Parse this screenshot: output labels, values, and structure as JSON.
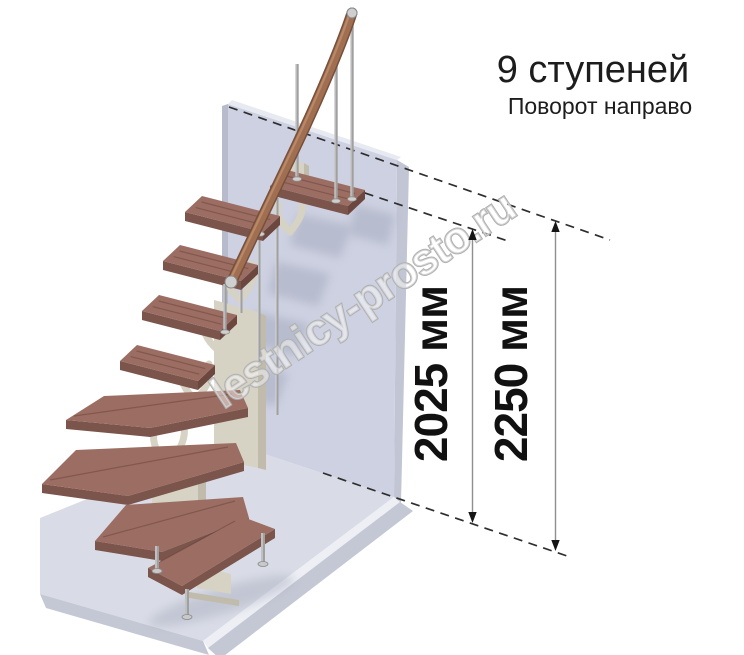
{
  "title": {
    "heading": "9 ступеней",
    "subheading": "Поворот направо"
  },
  "watermark": {
    "text": "lestnicy-prosto.ru"
  },
  "dimensions": {
    "items": [
      {
        "label": "2025 мм",
        "x": 472.5,
        "y_top": 229,
        "y_bottom": 523,
        "label_x": 447,
        "label_y": 374
      },
      {
        "label": "2250 мм",
        "x": 555.5,
        "y_top": 221,
        "y_bottom": 551,
        "label_x": 527,
        "label_y": 374
      }
    ],
    "dashed_levels": [
      {
        "name": "upper-floor-level",
        "x1": 229,
        "y1": 107,
        "x2": 610,
        "y2": 240
      },
      {
        "name": "top-step-level",
        "x1": 350,
        "y1": 188,
        "x2": 508,
        "y2": 241
      },
      {
        "name": "ground-level",
        "x1": 323,
        "y1": 473,
        "x2": 570,
        "y2": 557
      }
    ]
  },
  "colors": {
    "wall_front": "#cdd1e1",
    "wall_side": "#c1c5d4",
    "wall_top": "#e8eaf2",
    "wall_edge": "#b7bbcb",
    "floor_top": "#d9dce6",
    "floor_light": "#edeff5",
    "floor_dark": "#c4c7d4",
    "tread_top": "#9c6e63",
    "tread_front": "#7b544b",
    "tread_side": "#6b473f",
    "grain": "rgba(70,35,28,0.30)",
    "rail": "#a06f52",
    "rail_dark": "#77503c",
    "metal": "#a0a0a0",
    "metal_light": "#d6d6d6",
    "spine": "#d6d2c4",
    "spine_dark": "#c0bbaa",
    "dash": "#2e2e2e",
    "dim_line": "#8f8f8f",
    "arrow": "#151515",
    "shadow_wall": "#8b92a8",
    "shadow_floor": "#a8adbf"
  },
  "figure": {
    "wall": {
      "front": [
        [
          228,
          104
        ],
        [
          397,
          160
        ],
        [
          394,
          497
        ],
        [
          228,
          442
        ]
      ],
      "side": [
        [
          397,
          160
        ],
        [
          409,
          167
        ],
        [
          401,
          503
        ],
        [
          394,
          497
        ]
      ],
      "top": [
        [
          228,
          104
        ],
        [
          397,
          160
        ],
        [
          401,
          157
        ],
        [
          232,
          100
        ]
      ],
      "left": [
        [
          222,
          106
        ],
        [
          228,
          104
        ],
        [
          228,
          442
        ],
        [
          222,
          444
        ]
      ]
    },
    "floor": {
      "top": [
        [
          228,
          442
        ],
        [
          394,
          497
        ],
        [
          203,
          641
        ],
        [
          40,
          594
        ],
        [
          40,
          518
        ]
      ],
      "band_light": [
        [
          394,
          497
        ],
        [
          400,
          502
        ],
        [
          208,
          648
        ],
        [
          203,
          641
        ]
      ],
      "band_dark": [
        [
          400,
          502
        ],
        [
          413,
          511
        ],
        [
          220,
          659
        ],
        [
          208,
          648
        ]
      ],
      "band_left": [
        [
          203,
          641
        ],
        [
          209,
          655
        ],
        [
          46,
          608
        ],
        [
          40,
          594
        ]
      ]
    },
    "wall_shadows": [
      [
        [
          355,
          205
        ],
        [
          395,
          215
        ],
        [
          388,
          245
        ],
        [
          350,
          235
        ]
      ],
      [
        [
          298,
          214
        ],
        [
          352,
          226
        ],
        [
          340,
          258
        ],
        [
          290,
          245
        ]
      ],
      [
        [
          276,
          262
        ],
        [
          330,
          274
        ],
        [
          318,
          306
        ],
        [
          268,
          293
        ]
      ],
      [
        [
          255,
          312
        ],
        [
          309,
          324
        ],
        [
          297,
          356
        ],
        [
          247,
          343
        ]
      ],
      [
        [
          234,
          362
        ],
        [
          288,
          374
        ],
        [
          276,
          406
        ],
        [
          226,
          393
        ]
      ]
    ],
    "floor_shadow": {
      "cx": 222,
      "cy": 601,
      "rx": 76,
      "ry": 13,
      "rot": -17
    },
    "spine": {
      "columns": [
        {
          "face": [
            [
              214,
              300
            ],
            [
              258,
              312
            ],
            [
              258,
              468
            ],
            [
              214,
              458
            ]
          ],
          "side": [
            [
              258,
              312
            ],
            [
              266,
              316
            ],
            [
              266,
              470
            ],
            [
              258,
              468
            ]
          ]
        },
        {
          "face": [
            [
              152,
              468
            ],
            [
              198,
              478
            ],
            [
              198,
              548
            ],
            [
              152,
              540
            ]
          ],
          "side": [
            [
              198,
              478
            ],
            [
              206,
              482
            ],
            [
              206,
              550
            ],
            [
              198,
              548
            ]
          ]
        },
        {
          "face": [
            [
              286,
              158
            ],
            [
              304,
              163
            ],
            [
              304,
              182
            ],
            [
              286,
              177
            ]
          ],
          "side": [
            [
              304,
              163
            ],
            [
              309,
              166
            ],
            [
              309,
              184
            ],
            [
              304,
              182
            ]
          ]
        }
      ],
      "feet": [
        [
          [
            140,
            538
          ],
          [
            216,
            552
          ],
          [
            216,
            560
          ],
          [
            140,
            546
          ]
        ],
        [
          [
            189,
            592
          ],
          [
            239,
            600
          ],
          [
            239,
            606
          ],
          [
            189,
            598
          ]
        ]
      ],
      "bench_support": [
        [
          197,
          566
        ],
        [
          231,
          574
        ],
        [
          231,
          594
        ],
        [
          197,
          588
        ]
      ],
      "branches": [
        "M290,232 C300,220 304,212 302,200",
        "M290,232 C280,222 276,214 278,204",
        "M240,300 C252,286 256,276 252,264",
        "M240,300 C228,288 224,280 226,268",
        "M218,350 C230,336 234,326 231,314",
        "M218,350 C206,340 202,330 204,318",
        "M196,400 C208,386 212,376 209,364",
        "M196,400 C184,390 180,380 182,368",
        "M168,464 C182,448 186,438 184,424",
        "M168,464 C156,452 152,444 154,430",
        "M214,560 C224,548 228,540 226,530"
      ]
    },
    "treads": {
      "u": [
        78,
        20
      ],
      "v": [
        17,
        -16
      ],
      "thickness": 9,
      "straight": [
        {
          "name": "step-9",
          "fl": [
            270,
            186
          ]
        },
        {
          "name": "step-8",
          "fl": [
            185,
            212
          ]
        },
        {
          "name": "step-7",
          "fl": [
            163,
            261
          ]
        },
        {
          "name": "step-6",
          "fl": [
            142,
            311
          ]
        },
        {
          "name": "step-5",
          "fl": [
            120,
            361
          ]
        }
      ],
      "winders": [
        {
          "name": "step-4",
          "top": [
            [
              66,
              420
            ],
            [
              104,
              396
            ],
            [
              240,
              390
            ],
            [
              248,
              408
            ],
            [
              150,
              428
            ]
          ],
          "front": [
            [
              66,
              420
            ],
            [
              150,
              428
            ],
            [
              248,
              408
            ]
          ]
        },
        {
          "name": "step-3",
          "top": [
            [
              42,
              484
            ],
            [
              76,
              450
            ],
            [
              236,
              443
            ],
            [
              244,
              462
            ],
            [
              128,
              496
            ]
          ],
          "front": [
            [
              42,
              484
            ],
            [
              128,
              496
            ],
            [
              244,
              462
            ]
          ]
        },
        {
          "name": "step-2",
          "top": [
            [
              95,
              541
            ],
            [
              126,
              505
            ],
            [
              243,
              497
            ],
            [
              249,
              518
            ],
            [
              162,
              552
            ]
          ],
          "front": [
            [
              95,
              541
            ],
            [
              162,
              552
            ],
            [
              249,
              518
            ]
          ]
        },
        {
          "name": "step-1",
          "top": [
            [
              148,
              568
            ],
            [
              243,
              517
            ],
            [
              275,
              529
            ],
            [
              182,
              586
            ]
          ],
          "front": [
            [
              148,
              568
            ],
            [
              182,
              586
            ],
            [
              275,
              529
            ]
          ]
        }
      ]
    },
    "legs": [
      [
        187,
        589,
        617
      ],
      [
        263,
        533,
        564
      ],
      [
        157,
        546,
        571
      ]
    ],
    "background_posts": [
      [
        277,
        198,
        415
      ],
      [
        259,
        224,
        364
      ],
      [
        241,
        250,
        313
      ]
    ],
    "balusters": [
      [
        352,
        15,
        199
      ],
      [
        336,
        45,
        201
      ],
      [
        297,
        64,
        179
      ],
      [
        260,
        213,
        234
      ],
      [
        225,
        284,
        332
      ]
    ],
    "rail_path": "M352,13 C341,46 318,101 290,159 C269,203 247,249 232,281",
    "rail_caps": [
      {
        "cx": 352,
        "cy": 13,
        "r": 5
      },
      {
        "cx": 231,
        "cy": 282,
        "r": 6
      }
    ]
  }
}
